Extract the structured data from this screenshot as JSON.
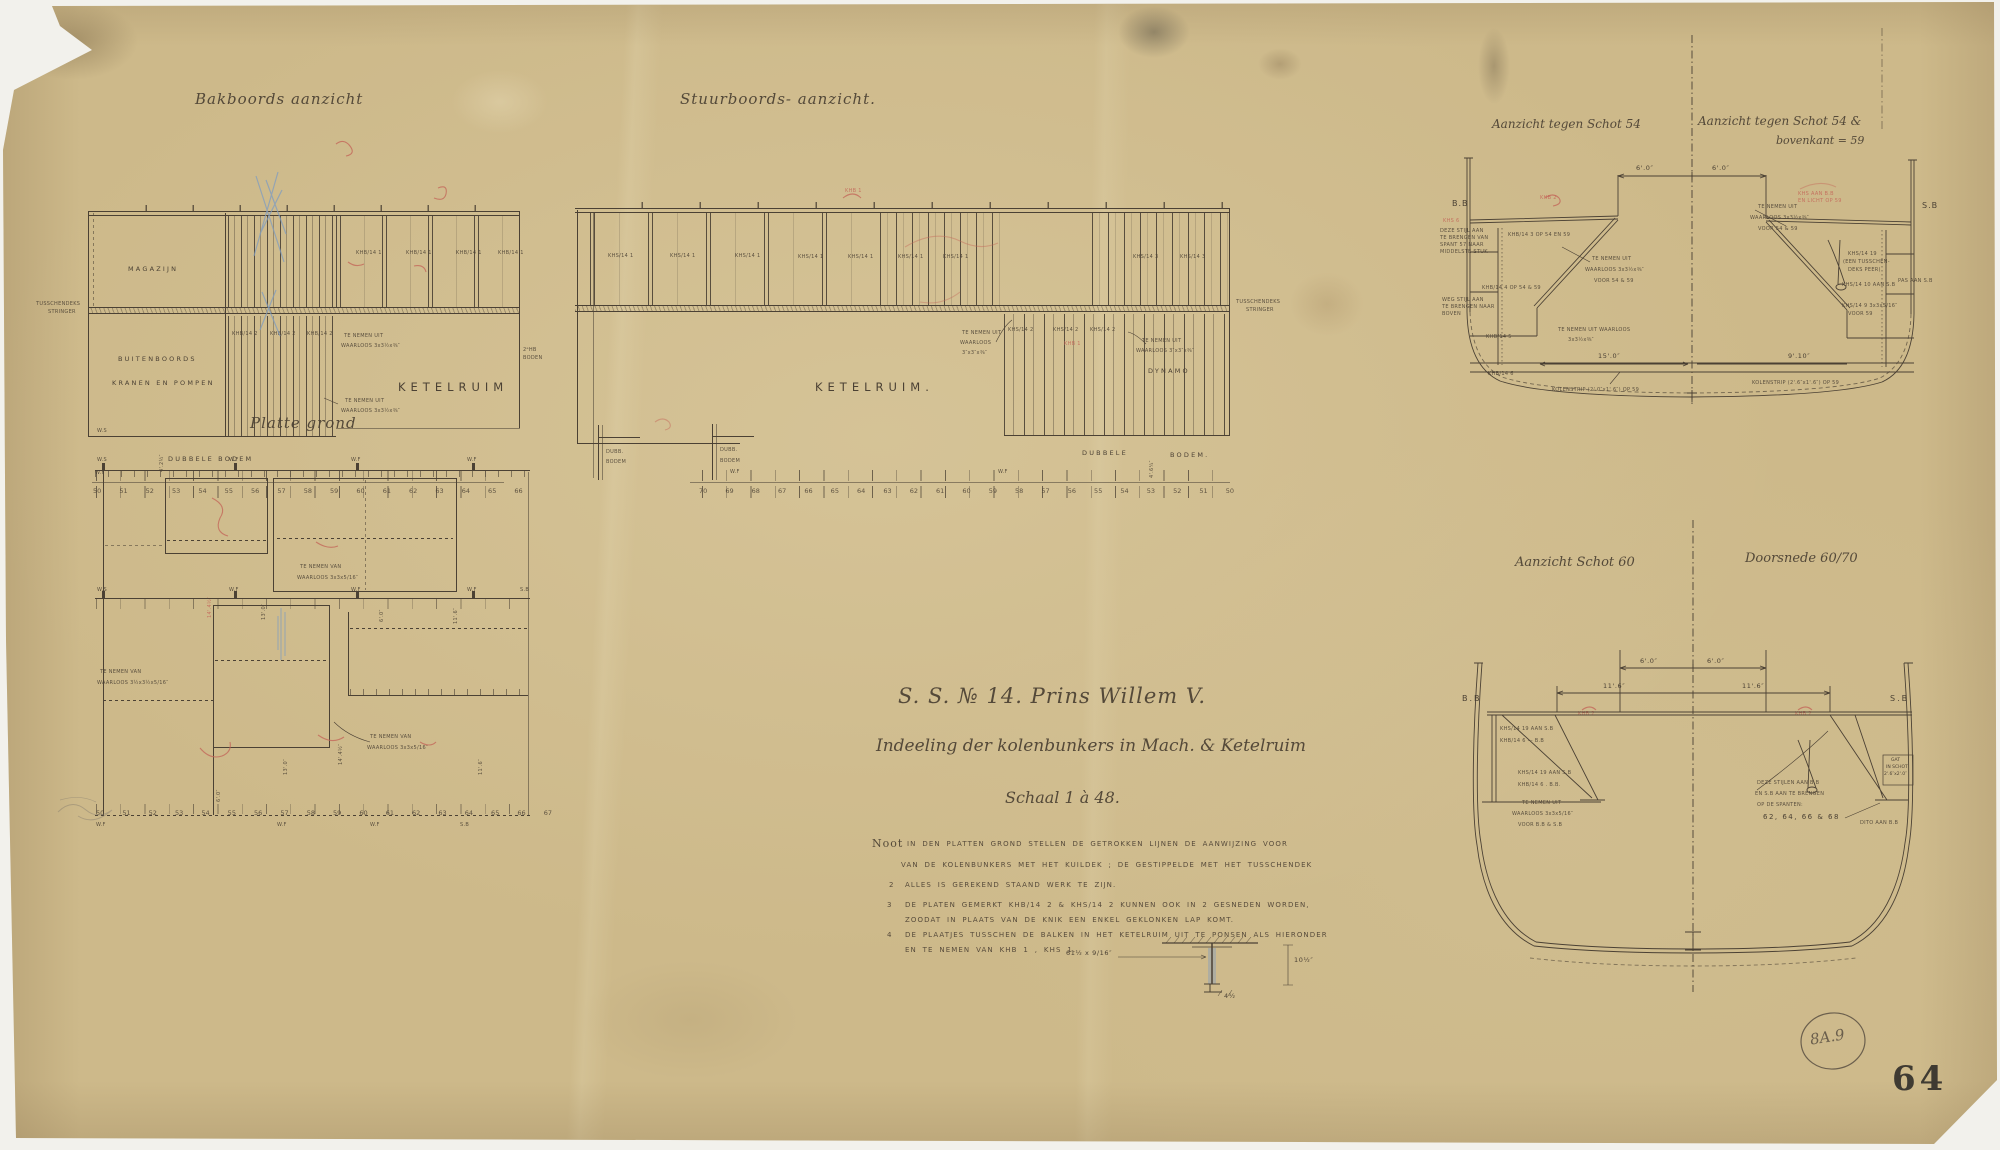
{
  "colors": {
    "paper": "#cdb98a",
    "ink": "#4b4134",
    "red_pencil": "#c4685a",
    "blue_pencil": "#7f9cc0",
    "stamp": "#33302b"
  },
  "sheet": {
    "stamp": "64",
    "plate_ref": "8A.9"
  },
  "titles": {
    "bakboord": "Bakboords aanzicht",
    "stuurboord": "Stuurboords- aanzicht.",
    "platte_grond": "Platte grond",
    "schot54_left": "Aanzicht tegen Schot 54",
    "schot54_right_1": "Aanzicht tegen Schot 54 &",
    "schot54_right_2": "bovenkant = 59",
    "schot60": "Aanzicht Schot 60",
    "doorsnede": "Doorsnede 60/70"
  },
  "title_block": {
    "ship": "S. S. № 14. Prins Willem V.",
    "subject": "Indeeling der kolenbunkers in Mach. & Ketelruim",
    "scale": "Schaal 1 à 48."
  },
  "notes": {
    "label": "Noot",
    "n1a": "IN DEN PLATTEN GROND STELLEN DE GETROKKEN LIJNEN DE AANWIJZING VOOR",
    "n1b": "VAN DE KOLENBUNKERS MET HET KUILDEK ; DE GESTIPPELDE MET HET TUSSCHENDEK",
    "n2_num": "2",
    "n2": "ALLES IS GEREKEND STAAND WERK TE ZIJN.",
    "n3_num": "3",
    "n3a": "DE PLATEN GEMERKT KHB/14 2 & KHS/14 2 KUNNEN OOK IN 2 GESNEDEN WORDEN,",
    "n3b": "ZOODAT IN PLAATS VAN DE KNIK EEN ENKEL GEKLONKEN LAP KOMT.",
    "n4_num": "4",
    "n4a": "DE PLAATJES TUSSCHEN DE BALKEN IN HET KETELRUIM UIT TE PONSEN ALS HIERONDER",
    "n4b": "EN TE NEMEN VAN KHB 1 , KHS 1.",
    "detail_dim_left": "61½ x 9/16″",
    "detail_dim_right": "10½″",
    "detail_dim_bottom": "4½"
  },
  "bakboord": {
    "magazijn": "MAGAZIJN",
    "tusschendeks_1": "TUSSCHENDEKS",
    "tusschendeks_2": "STRINGER",
    "buitenboords_1": "BUITENBOORDS",
    "buitenboords_2": "KRANEN EN POMPEN",
    "ketelruim": "KETELRUIM",
    "khb1": "KHB/14 1",
    "khb2": "KHB/14 2",
    "note_1": "TE NEMEN UIT",
    "note_2": "WAARLOOS 3x3½x⅜″",
    "hb_boden_1": "2ᵉHB",
    "hb_boden_2": "BODEN",
    "dubbele_bodem": "DUBBELE BODEM",
    "dim_rot": "4'.2½″",
    "ws": "W.S",
    "wf": "W.F",
    "frames": "50 51 52 53 54 55 56 57 58 59 60 61 62 63 64 65 66"
  },
  "stuurboord": {
    "ketelruim": "KETELRUIM.",
    "dynamo": "DYNAMO",
    "khs1": "KHS/14 1",
    "khs2": "KHS/14 2",
    "khs3": "KHS/14 3",
    "note_a1": "TE NEMEN UIT",
    "note_a2": "WAARLOOS",
    "note_a3": "3″x3″x⅜″",
    "note_b1": "TE NEMEN UIT",
    "note_b2": "WAARLOOS 3″x3″x⅜″",
    "tusschendeks_1": "TUSSCHENDEKS",
    "tusschendeks_2": "STRINGER",
    "dubb_1": "DUBB.",
    "dubb_2": "BODEM",
    "dubbele": "DUBBELE",
    "bodem": "BODEM.",
    "dim_rot": "4'.6¼″",
    "wf": "W.F",
    "red_khb": "KHB 1",
    "frames": "70 69 68 67 66 65 64 63 62 61 60 59 58 57 56 55 54 53 52 51 50"
  },
  "plan": {
    "ws": "W.S",
    "wf": "W.F",
    "sb": "S.B",
    "dim_13": "13'.0″",
    "dim_6": "6'.0″",
    "dim_11": "11'.6″",
    "dim_14": "14'.4½″",
    "note_1": "TE NEMEN VAN",
    "note_2": "WAARLOOS 3x3x5/16″",
    "note_left_1": "TE NEMEN VAN",
    "note_left_2": "WAARLOOS 3½x3½x5/16″",
    "red_dim": "14'.4½″",
    "frames": "50 51 52 53 54 55 56 57 58 59 60 61 62 63 64 65 66 67"
  },
  "schot54": {
    "bb": "B.B",
    "sb": "S.B",
    "dim6": "6'.0″",
    "khb3": "KHB/14 3  OP 54 EN 59",
    "khb4": "KHB/14 4  OP 54 & 59",
    "khb5": "KHB/14 5",
    "khb6": "KHB/14 6",
    "note_a1": "TE NEMEN UIT",
    "note_a2": "WAARLOOS 3x3½x⅜″",
    "note_a3": "VOOR 54 & 59",
    "note_b1": "TE NEMEN UIT WAARLOOS",
    "note_b2": "3x3½x⅜″",
    "dim15": "15'.0″",
    "dim910": "9'.10″",
    "kolenstrip_l": "KOLENSTRIP (2'.0″x1'.6″) OP 59",
    "kolenstrip_r": "KOLENSTRIP (2'.6″x1'.6″) OP 59",
    "blockA_1": "DEZE STIJL AAN",
    "blockA_2": "TE BRENGEN VAN",
    "blockA_3": "SPANT 57 NAAR",
    "blockA_4": "MIDDELSTE STUK",
    "blockB_1": "WEG STIJL AAN",
    "blockB_2": "TE BRENGEN NAAR",
    "blockB_3": "BOVEN",
    "khs19_1": "KHS/14 19",
    "khs19_2": "(EEN TUSSCHEN-",
    "khs19_3": "DEKS PEER)",
    "khs10": "KHS/14 10 AAN S.B",
    "pas": "PAS AAN S.B",
    "khs9_1": "KHS/14 9  3x3x5/16″",
    "khs9_2": "VOOR 59",
    "red_1": "KHS AAN B.B",
    "red_2": "EN LICHT OP 59",
    "red_3": "KHB 2",
    "red_4": "KHS 6"
  },
  "schot60": {
    "bb": "B.B",
    "sb": "S.B",
    "dim6": "6'.0″",
    "dim11": "11'.6″",
    "pair1_1": "KHS/14 19 AAN S.B",
    "pair1_2": "KHB/14 6 — B.B",
    "pair2_1": "KHS/14 19 AAN S.B",
    "pair2_2": "KHB/14 6 . B.B.",
    "note_1": "TE NEMEN UIT",
    "note_2": "WAARLOOS 3x3x5/16″",
    "note_3": "VOOR B.B & S.B",
    "stijlen_1": "DEZE STIJLEN AAN B.B",
    "stijlen_2": "EN S.B AAN TE BRENGEN",
    "stijlen_3": "OP DE SPANTEN:",
    "stijlen_4": "62, 64, 66 & 68",
    "dito": "DITO AAN B.B",
    "gat_1": "GAT",
    "gat_2": "IN SCHOT",
    "gat_3": "2'.6″x2'.0″",
    "red": "KHB 2"
  }
}
